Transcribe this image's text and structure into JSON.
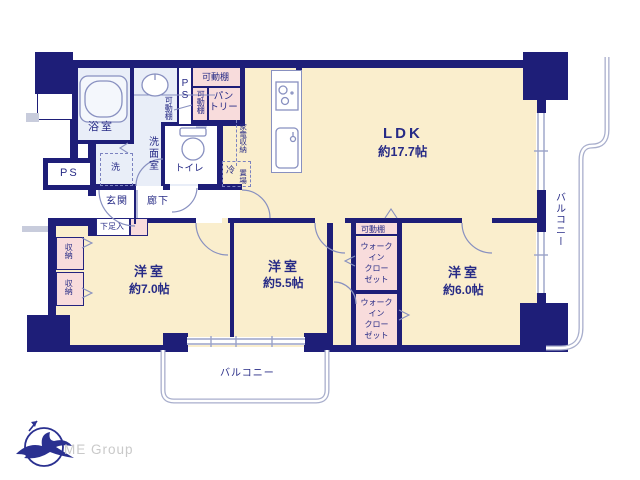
{
  "logo": {
    "name": "ME Group"
  },
  "rooms": {
    "ldk": {
      "name": "LDK",
      "area": "約17.7帖"
    },
    "bedroom_west": {
      "name": "洋室",
      "area": "約7.0帖"
    },
    "bedroom_center": {
      "name": "洋室",
      "area": "約5.5帖"
    },
    "bedroom_east": {
      "name": "洋室",
      "area": "約6.0帖"
    },
    "bathroom": "浴室",
    "washroom": "洗面室",
    "toilet": "トイレ",
    "entrance": "玄関",
    "hallway": "廊下",
    "pantry_line1": "パン",
    "pantry_line2": "トリー",
    "balcony_south": "バルコニー",
    "balcony_east": "バルコニー"
  },
  "fixtures": {
    "pipe_space_top": "PS",
    "pipe_space_left": "PS",
    "shelf_top": "可動棚",
    "shelf_pantry": "可動棚",
    "shelf_washroom": "可動棚",
    "shelf_wic": "可動棚",
    "wic_lines": [
      "ウォーク",
      "イン",
      "クロー",
      "ゼット"
    ],
    "storage": "収納",
    "shoe_cabinet": "下足入",
    "washer": "洗",
    "fridge": "冷",
    "appliance_col1": "家電収納",
    "appliance_col2": "置場"
  },
  "colors": {
    "wall": "#1e1e78",
    "floor": "#faeecd",
    "closet": "#f8dcdc",
    "wet_area": "#e9eef8",
    "thin_line": "#8890c0",
    "balcony_line": "#a8aecc",
    "text": "#272b86",
    "brand_text": "#c9c9c9"
  }
}
